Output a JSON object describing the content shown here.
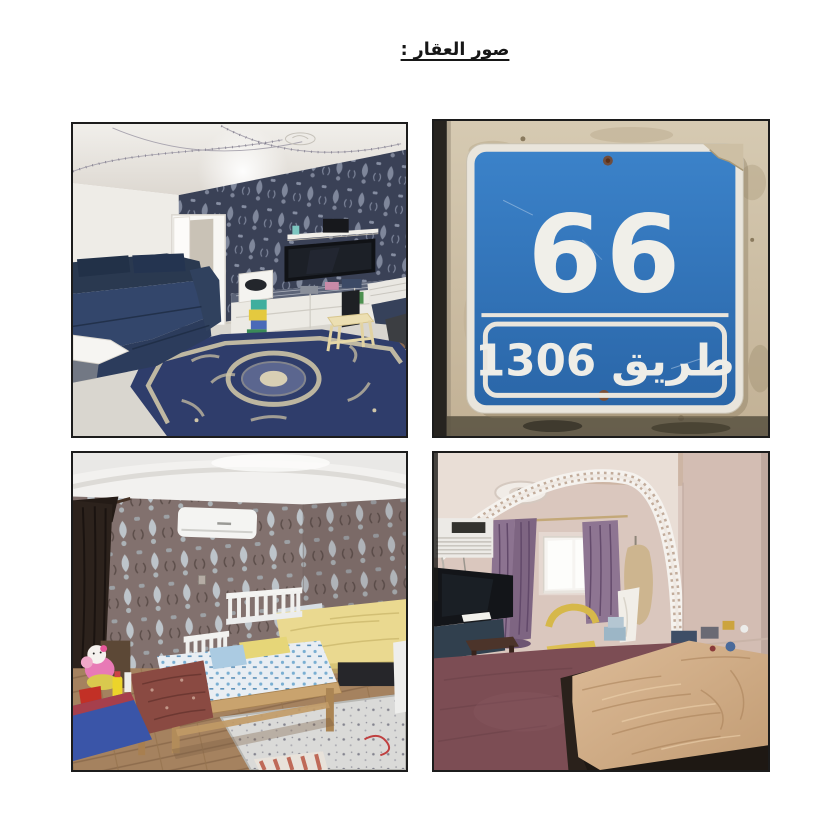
{
  "title": "صور العقار :",
  "photos": {
    "living_room": {
      "description": "Living room with dark blue sofa, navy damask wallpaper, wall-mounted TV above a white console and a large ornate blue carpet"
    },
    "street_sign": {
      "description": "Blue metal building-number plate with white border mounted on a weathered beige wall",
      "number": "66",
      "road_label": "طريق 1306"
    },
    "kids_bedroom": {
      "description": "Children's bedroom with mauve damask wallpaper, split AC unit, white-railed wooden kids beds and toys on the floor"
    },
    "master_bedroom": {
      "description": "Bedroom with decorative white arch, window with purple curtains, TV, yellow chair, maroon carpet and a large bed"
    }
  },
  "colors": {
    "page_background": "#ffffff",
    "photo_border": "#1c1c1c",
    "sign_blue": "#2f74bd",
    "sign_text": "#f0efe9"
  }
}
